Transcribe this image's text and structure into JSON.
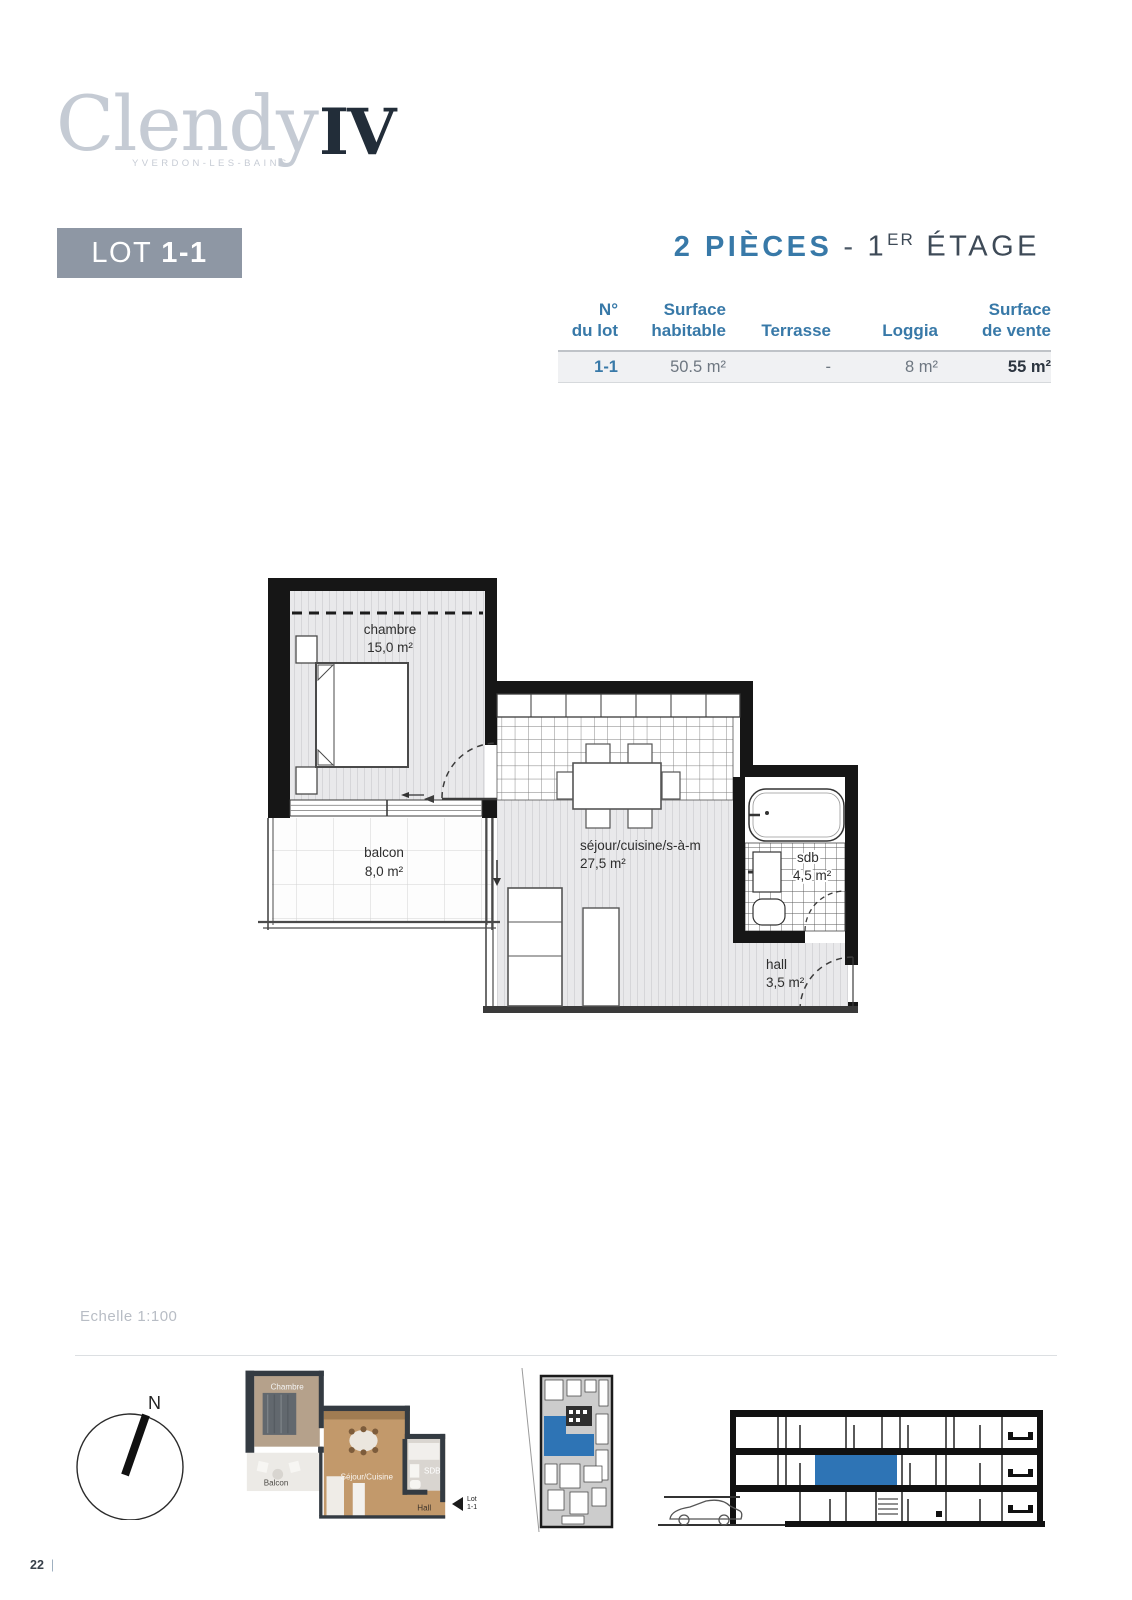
{
  "brand": {
    "name": "Clendy",
    "suffix": "IV",
    "location": "YVERDON-LES-BAINS"
  },
  "lot": {
    "label": "LOT",
    "number": "1-1"
  },
  "heading": {
    "rooms": "2 PIÈCES",
    "sep": "-",
    "floor_base": "1",
    "floor_sup": "ER",
    "floor_rest": "ÉTAGE"
  },
  "table": {
    "headers": [
      {
        "line1": "N°",
        "line2": "du lot"
      },
      {
        "line1": "Surface",
        "line2": "habitable"
      },
      {
        "line1": "",
        "line2": "Terrasse"
      },
      {
        "line1": "",
        "line2": "Loggia"
      },
      {
        "line1": "Surface",
        "line2": "de vente"
      }
    ],
    "row": {
      "lot": "1-1",
      "habitable": "50.5 m²",
      "terrasse": "-",
      "loggia": "8 m²",
      "vente": "55 m²"
    }
  },
  "plan": {
    "rooms": [
      {
        "name": "chambre",
        "area": "15,0 m²"
      },
      {
        "name": "balcon",
        "area": "8,0 m²"
      },
      {
        "name": "séjour/cuisine/s-à-m",
        "area": "27,5 m²"
      },
      {
        "name": "sdb",
        "area": "4,5 m²"
      },
      {
        "name": "hall",
        "area": "3,5 m²"
      }
    ]
  },
  "scale_label": "Echelle 1:100",
  "compass": {
    "north": "N"
  },
  "mini_plan": {
    "labels": {
      "chambre": "Chambre",
      "balcon": "Balcon",
      "sejour": "Séjour/Cuisine",
      "sdb": "SDB",
      "hall": "Hall"
    },
    "tag_line1": "Lot",
    "tag_line2": "1-1"
  },
  "footer": {
    "page": "22",
    "bar": "|"
  },
  "colors": {
    "accent_blue": "#3879a8",
    "dark_slate": "#3e4a57",
    "badge_gray": "#8e97a4",
    "highlight_blue": "#2e74b5"
  }
}
